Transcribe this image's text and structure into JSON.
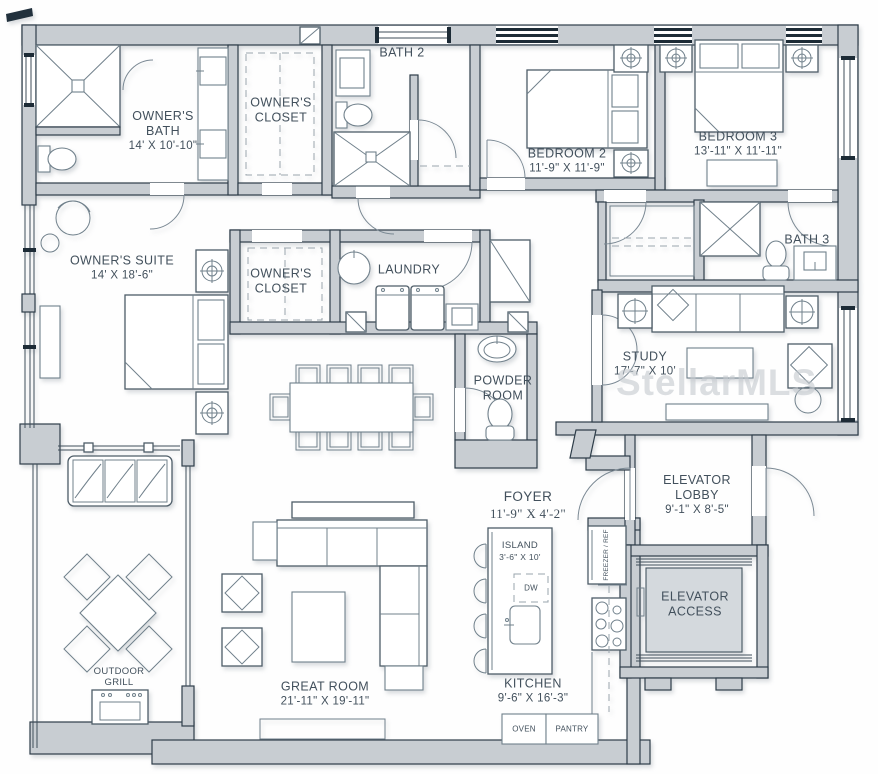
{
  "watermark": "StellarMLS",
  "rooms": {
    "owners_bath": {
      "name": "OWNER'S BATH",
      "dims": "14' X 10'-10\""
    },
    "owners_closet_upper": {
      "name": "OWNER'S CLOSET"
    },
    "bath_2": {
      "name": "BATH 2"
    },
    "bedroom_2": {
      "name": "BEDROOM 2",
      "dims": "11'-9\" X 11'-9\""
    },
    "bedroom_3": {
      "name": "BEDROOM 3",
      "dims": "13'-11\" X 11'-11\""
    },
    "bath_3": {
      "name": "BATH 3"
    },
    "owners_suite": {
      "name": "OWNER'S SUITE",
      "dims": "14' X 18'-6\""
    },
    "owners_closet_lower": {
      "name": "OWNER'S CLOSET"
    },
    "laundry": {
      "name": "LAUNDRY"
    },
    "study": {
      "name": "STUDY",
      "dims": "17'-7\" X 10'"
    },
    "powder_room": {
      "name": "POWDER ROOM"
    },
    "foyer": {
      "name": "FOYER",
      "dims": "11'-9\" X 4'-2\""
    },
    "elevator_lobby": {
      "name": "ELEVATOR LOBBY",
      "dims": "9'-1\" X 8'-5\""
    },
    "elevator_access": {
      "name": "ELEVATOR ACCESS"
    },
    "island": {
      "name": "ISLAND",
      "dims": "3'-6\" X 10'"
    },
    "kitchen": {
      "name": "KITCHEN",
      "dims": "9'-6\" X 16'-3\""
    },
    "great_room": {
      "name": "GREAT ROOM",
      "dims": "21'-11\" X 19'-11\""
    },
    "outdoor_grill": {
      "name": "OUTDOOR GRILL"
    }
  },
  "appliances": {
    "oven": "OVEN",
    "pantry": "PANTRY",
    "freezer_ref": "FREEZER / REF",
    "dishwasher": "DW"
  },
  "colors": {
    "wall_fill": "#c8cdd2",
    "wall_stroke": "#2e3d49",
    "window_bar": "#1d2b36",
    "furniture_line": "#70808b",
    "label_text": "#42505c",
    "watermark": "#c6cbd0",
    "background": "#ffffff"
  }
}
